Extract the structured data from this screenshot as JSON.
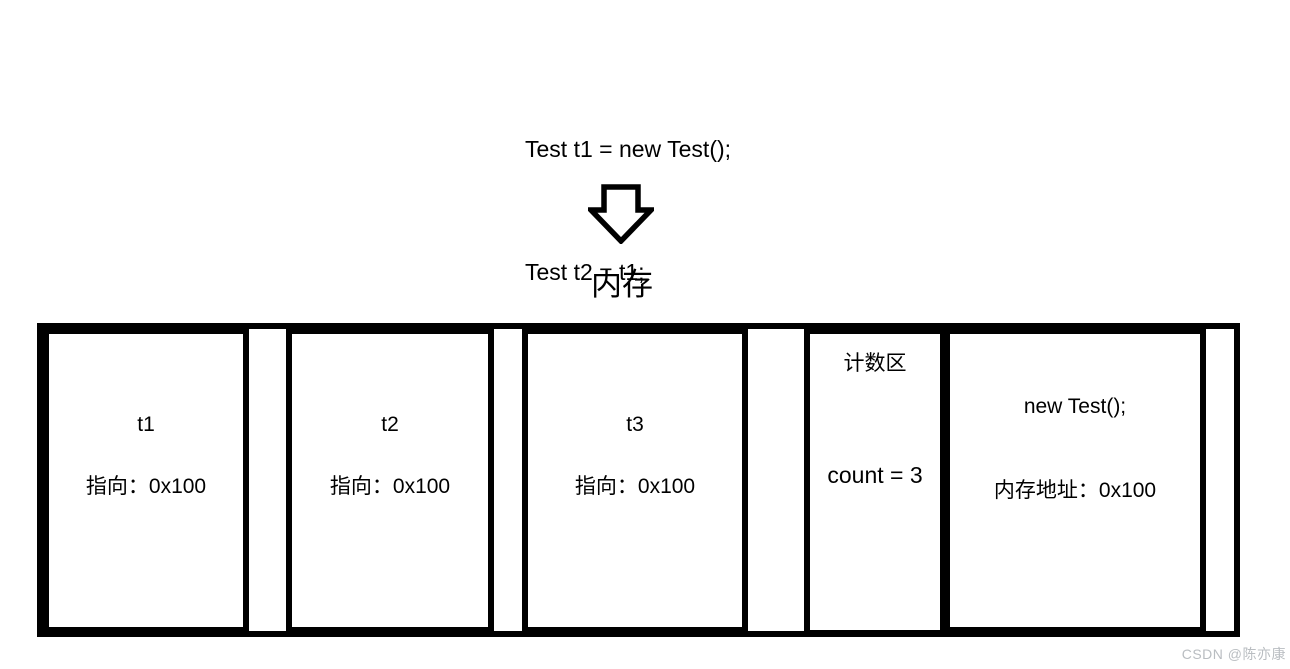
{
  "code_block": {
    "lines": [
      "Test t1 = new Test();",
      "Test t2 = t1;",
      "Test t3 = t1;"
    ]
  },
  "memory_label": "内存",
  "memory_diagram": {
    "boxes": [
      {
        "id": "t1",
        "title": "t1",
        "detail": "指向：0x100"
      },
      {
        "id": "t2",
        "title": "t2",
        "detail": "指向：0x100"
      },
      {
        "id": "t3",
        "title": "t3",
        "detail": "指向：0x100"
      },
      {
        "id": "counter",
        "title": "计数区",
        "detail": "count = 3"
      },
      {
        "id": "object",
        "title": "new Test();",
        "detail": "内存地址：0x100"
      }
    ]
  },
  "watermark": "CSDN @陈亦康",
  "colors": {
    "border": "#000000",
    "text": "#000000",
    "watermark": "#b9bdc1",
    "background": "#ffffff"
  }
}
